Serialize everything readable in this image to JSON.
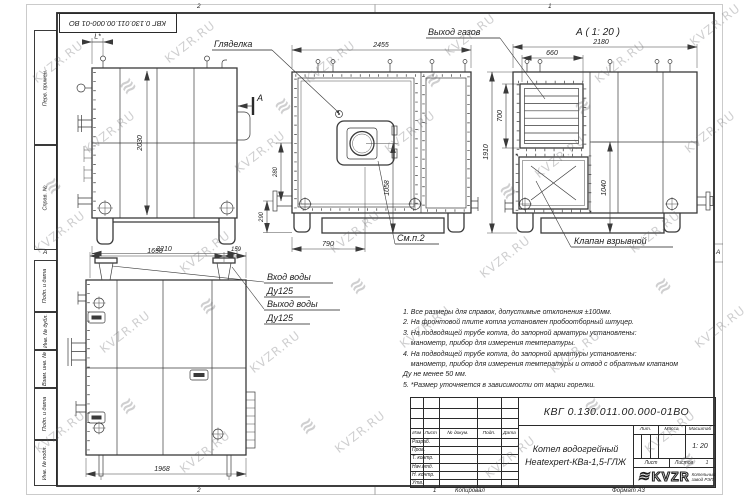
{
  "colors": {
    "line": "#3a3a3a",
    "frame": "#2a2a2a",
    "watermark": "#9b9b9b",
    "paper": "#ffffff"
  },
  "watermark": {
    "text": "KVZR.RU",
    "logo_glyph": "≋",
    "text_positions": [
      [
        28,
        55
      ],
      [
        160,
        35
      ],
      [
        300,
        55
      ],
      [
        440,
        28
      ],
      [
        590,
        55
      ],
      [
        685,
        18
      ],
      [
        80,
        125
      ],
      [
        230,
        145
      ],
      [
        380,
        125
      ],
      [
        530,
        150
      ],
      [
        680,
        125
      ],
      [
        30,
        225
      ],
      [
        175,
        245
      ],
      [
        325,
        225
      ],
      [
        475,
        250
      ],
      [
        625,
        225
      ],
      [
        95,
        325
      ],
      [
        245,
        345
      ],
      [
        395,
        320
      ],
      [
        545,
        345
      ],
      [
        690,
        320
      ],
      [
        30,
        425
      ],
      [
        175,
        445
      ],
      [
        330,
        425
      ],
      [
        480,
        450
      ],
      [
        640,
        425
      ]
    ],
    "logo_positions": [
      [
        120,
        75
      ],
      [
        275,
        95
      ],
      [
        425,
        68
      ],
      [
        575,
        95
      ],
      [
        45,
        175
      ],
      [
        200,
        295
      ],
      [
        350,
        275
      ],
      [
        500,
        180
      ],
      [
        655,
        275
      ],
      [
        120,
        395
      ],
      [
        300,
        415
      ],
      [
        585,
        395
      ],
      [
        680,
        450
      ]
    ]
  },
  "corner_stamp": {
    "text": "КВГ 0.130.011.00.000-01 ВО"
  },
  "margin_labels": {
    "perv_primen": "Перв. примен.",
    "sprav_no": "Справ. №",
    "podp_data_1": "Подп. и дата",
    "inv_no_dubl": "Инв. № дубл.",
    "vzam_inv_no": "Взам. инв. №",
    "podp_data_2": "Подп. и дата",
    "inv_no_podl": "Инв. № подл."
  },
  "zones": {
    "top_left": "2",
    "top_right": "1",
    "bottom_left": "2",
    "left_a": "А",
    "right_a": "А"
  },
  "labels": {
    "gljadelka": "Гляделка",
    "vyhod_gazov": "Выход газов",
    "section_view_title": "А ( 1: 20 )",
    "section_letter": "А",
    "sm_p2": "См.п.2",
    "klapan_vzryvnoj": "Клапан взрывной",
    "vhod_vody": "Вход воды",
    "vhod_du": "Ду125",
    "vyhod_vody": "Выход воды",
    "vyhod_du": "Ду125"
  },
  "dims": {
    "l_star": "L*",
    "h2030": "2030",
    "w2210": "2210",
    "h290": "290",
    "w2455": "2455",
    "w790": "790",
    "h1058": "1058",
    "h280": "280",
    "h1910": "1910",
    "w2180": "2180",
    "w660": "660",
    "h700": "700",
    "h1040": "1040",
    "w1650": "1650",
    "w159": "159",
    "w1968": "1968"
  },
  "notes": {
    "lines": [
      "1. Все размеры для справок, допустимые отклонения ±100мм.",
      "2. На фронтовой плите котла установлен пробоотборный штуцер.",
      "3. На подводящей трубе котла, до запорной арматуры установлены:",
      "    манометр, прибор для измерения температуры.",
      "4. На подводящей трубе котла, до запорной арматуры установлены:",
      "    манометр, прибор для измерения температуры и отвод с обратным клапаном",
      "Ду не менее 50 мм.",
      "5. *Размер уточняется в зависимости от марки горелки."
    ]
  },
  "titleblock": {
    "doc_number": "КВГ 0.130.011.00.000-01ВО",
    "title_line1": "Котел водогрейный",
    "title_line2": "Heatexpert-КВа-1,5-ГЛЖ",
    "header": {
      "izm": "Изм",
      "list": "Лист",
      "n_dokum": "№ докум.",
      "podp": "Подп.",
      "data": "Дата"
    },
    "sign_rows": [
      "Разраб.",
      "Пров.",
      "Т. контр.",
      "Нач.отд.",
      "Н. контр.",
      "Утв."
    ],
    "lit_label": "Лит.",
    "massa_label": "Масса",
    "masshtab_label": "Масштаб",
    "scale_value": "1: 20",
    "list_label": "Лист",
    "listov_label": "Листов",
    "listov_value": "1",
    "company_logo": "KVZR",
    "company_line1": "Котельный",
    "company_line2": "завод РЭП"
  },
  "footer": {
    "copy_num": "1",
    "kopiroval": "Копировал",
    "format": "Формат А3"
  }
}
